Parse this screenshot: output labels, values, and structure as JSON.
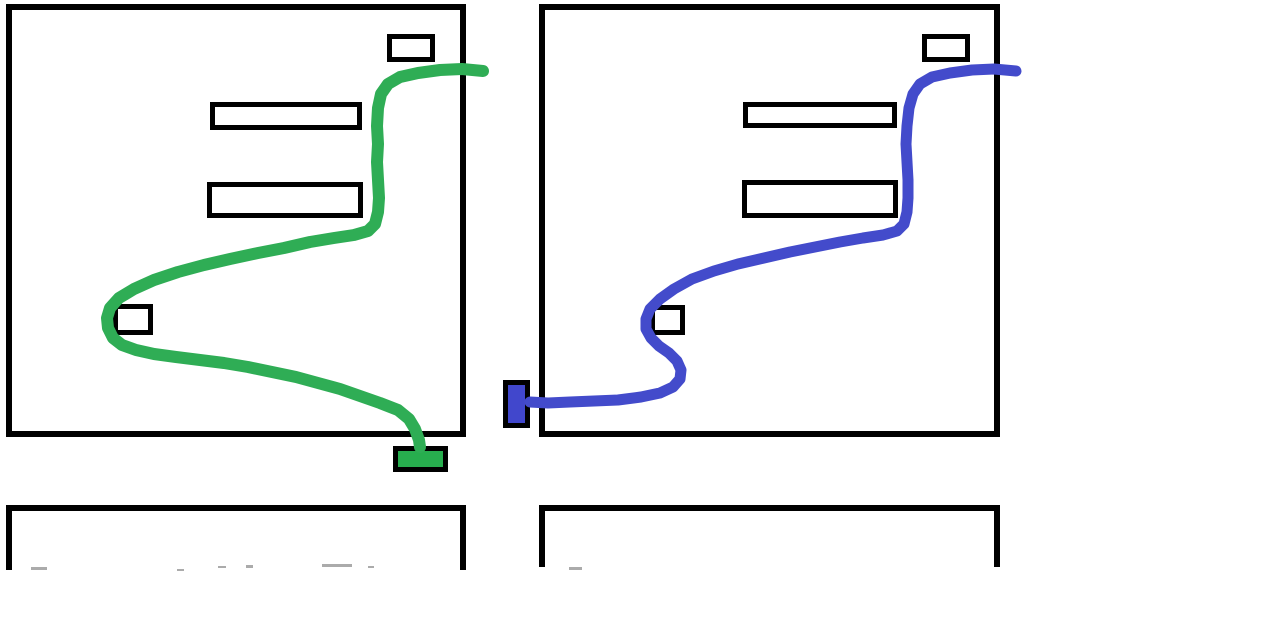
{
  "canvas": {
    "width": 1274,
    "height": 630,
    "background": "#ffffff"
  },
  "colors": {
    "outline": "#000000",
    "green_path": "#2FAD55",
    "green_fill": "#27AE4E",
    "blue_path": "#434BCB",
    "blue_fill": "#4147CC",
    "faint_mark": "#8f8f8f"
  },
  "panels": [
    {
      "name": "left-screen-panel",
      "outline": {
        "x": 6,
        "y": 4,
        "w": 460,
        "h": 433,
        "stroke": 6
      },
      "boxes": [
        {
          "name": "left-top-right-box",
          "x": 387,
          "y": 34,
          "w": 48,
          "h": 28,
          "stroke": 5
        },
        {
          "name": "left-menu-bar-1",
          "x": 210,
          "y": 102,
          "w": 152,
          "h": 28,
          "stroke": 5
        },
        {
          "name": "left-menu-bar-2",
          "x": 207,
          "y": 182,
          "w": 156,
          "h": 36,
          "stroke": 5
        },
        {
          "name": "left-small-square",
          "x": 113,
          "y": 304,
          "w": 40,
          "h": 31,
          "stroke": 5
        }
      ],
      "marker": {
        "name": "green-end-marker",
        "x": 393,
        "y": 446,
        "w": 55,
        "h": 26,
        "stroke": 5,
        "fill": "green_fill"
      },
      "path": {
        "name": "green-cursor-path",
        "color": "green_path",
        "width": 12,
        "points": [
          [
            483,
            71
          ],
          [
            462,
            69
          ],
          [
            440,
            70
          ],
          [
            418,
            73
          ],
          [
            400,
            77
          ],
          [
            388,
            84
          ],
          [
            381,
            94
          ],
          [
            378,
            108
          ],
          [
            377,
            126
          ],
          [
            378,
            144
          ],
          [
            377,
            162
          ],
          [
            378,
            180
          ],
          [
            379,
            198
          ],
          [
            378,
            212
          ],
          [
            375,
            224
          ],
          [
            368,
            231
          ],
          [
            354,
            235
          ],
          [
            334,
            238
          ],
          [
            310,
            242
          ],
          [
            284,
            248
          ],
          [
            258,
            253
          ],
          [
            230,
            259
          ],
          [
            204,
            265
          ],
          [
            178,
            272
          ],
          [
            154,
            280
          ],
          [
            134,
            289
          ],
          [
            119,
            298
          ],
          [
            110,
            308
          ],
          [
            107,
            318
          ],
          [
            108,
            328
          ],
          [
            113,
            338
          ],
          [
            122,
            345
          ],
          [
            136,
            350
          ],
          [
            154,
            354
          ],
          [
            176,
            357
          ],
          [
            200,
            360
          ],
          [
            224,
            363
          ],
          [
            248,
            367
          ],
          [
            272,
            372
          ],
          [
            296,
            377
          ],
          [
            318,
            383
          ],
          [
            340,
            389
          ],
          [
            360,
            396
          ],
          [
            380,
            403
          ],
          [
            398,
            410
          ],
          [
            409,
            419
          ],
          [
            415,
            429
          ],
          [
            419,
            440
          ],
          [
            420,
            447
          ]
        ]
      }
    },
    {
      "name": "right-screen-panel",
      "outline": {
        "x": 539,
        "y": 4,
        "w": 461,
        "h": 433,
        "stroke": 6
      },
      "boxes": [
        {
          "name": "right-top-right-box",
          "x": 922,
          "y": 34,
          "w": 48,
          "h": 28,
          "stroke": 5
        },
        {
          "name": "right-menu-bar-1",
          "x": 743,
          "y": 102,
          "w": 154,
          "h": 26,
          "stroke": 5
        },
        {
          "name": "right-menu-bar-2",
          "x": 742,
          "y": 180,
          "w": 156,
          "h": 38,
          "stroke": 5
        },
        {
          "name": "right-small-square",
          "x": 650,
          "y": 305,
          "w": 35,
          "h": 30,
          "stroke": 5
        }
      ],
      "marker": {
        "name": "blue-end-marker",
        "x": 503,
        "y": 380,
        "w": 27,
        "h": 48,
        "stroke": 5,
        "fill": "blue_fill"
      },
      "path": {
        "name": "blue-cursor-path",
        "color": "blue_path",
        "width": 11,
        "points": [
          [
            1016,
            71
          ],
          [
            994,
            69
          ],
          [
            972,
            70
          ],
          [
            950,
            73
          ],
          [
            932,
            77
          ],
          [
            920,
            84
          ],
          [
            913,
            94
          ],
          [
            909,
            108
          ],
          [
            907,
            126
          ],
          [
            906,
            144
          ],
          [
            907,
            162
          ],
          [
            908,
            180
          ],
          [
            908,
            198
          ],
          [
            907,
            212
          ],
          [
            904,
            224
          ],
          [
            897,
            231
          ],
          [
            883,
            235
          ],
          [
            863,
            238
          ],
          [
            840,
            242
          ],
          [
            815,
            247
          ],
          [
            790,
            252
          ],
          [
            764,
            258
          ],
          [
            738,
            264
          ],
          [
            714,
            271
          ],
          [
            692,
            279
          ],
          [
            674,
            289
          ],
          [
            660,
            299
          ],
          [
            650,
            309
          ],
          [
            646,
            319
          ],
          [
            646,
            329
          ],
          [
            651,
            338
          ],
          [
            659,
            346
          ],
          [
            669,
            353
          ],
          [
            677,
            361
          ],
          [
            681,
            370
          ],
          [
            680,
            379
          ],
          [
            673,
            387
          ],
          [
            660,
            393
          ],
          [
            641,
            397
          ],
          [
            618,
            400
          ],
          [
            594,
            401
          ],
          [
            570,
            402
          ],
          [
            548,
            403
          ],
          [
            530,
            402
          ]
        ]
      }
    }
  ],
  "lower_boxes": [
    {
      "name": "left-lower-cropped-box",
      "x": 6,
      "y": 505,
      "w": 460,
      "h": 65,
      "stroke": 6
    },
    {
      "name": "right-lower-cropped-box",
      "x": 539,
      "y": 505,
      "w": 461,
      "h": 62,
      "stroke": 6
    }
  ],
  "faint_marks": [
    {
      "x": 31,
      "y": 567,
      "w": 16,
      "h": 3
    },
    {
      "x": 177,
      "y": 569,
      "w": 7,
      "h": 2
    },
    {
      "x": 218,
      "y": 566,
      "w": 8,
      "h": 2
    },
    {
      "x": 246,
      "y": 565,
      "w": 7,
      "h": 3
    },
    {
      "x": 322,
      "y": 564,
      "w": 30,
      "h": 3
    },
    {
      "x": 368,
      "y": 566,
      "w": 6,
      "h": 2
    },
    {
      "x": 569,
      "y": 567,
      "w": 13,
      "h": 3
    }
  ]
}
